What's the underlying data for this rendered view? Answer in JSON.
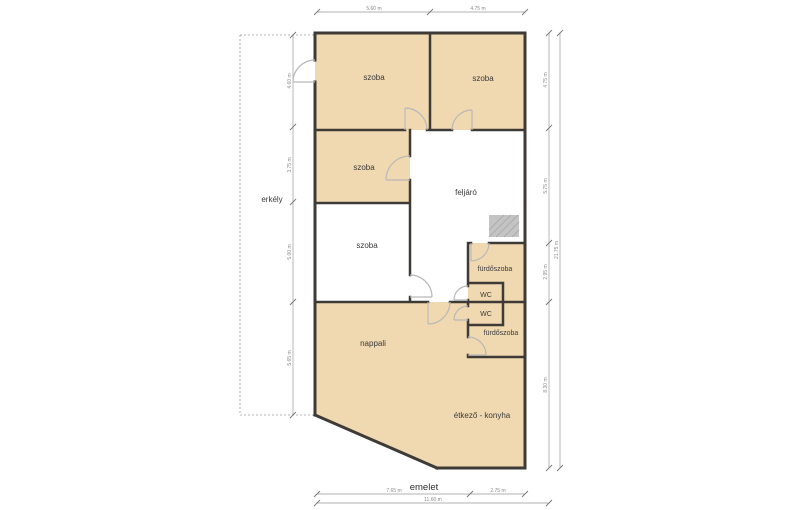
{
  "title": "emelet",
  "rooms": {
    "bedroom_top_left": "szoba",
    "bedroom_top_right": "szoba",
    "bedroom_middle": "szoba",
    "bedroom_lower": "szoba",
    "landing": "feljáró",
    "balcony": "erkély",
    "bathroom_upper": "fürdőszoba",
    "wc_upper": "WC",
    "wc_lower": "WC",
    "bathroom_lower": "fürdőszoba",
    "living_room": "nappali",
    "dining_kitchen": "étkező - konyha"
  },
  "dimensions": {
    "top": [
      "5.60 m",
      "4.75 m"
    ],
    "bottom": [
      "7.65 m",
      "2.75 m"
    ],
    "bottom_total": "11.60 m",
    "left": [
      "4.60 m",
      "3.75 m",
      "5.00 m",
      "5.65 m"
    ],
    "right": [
      "4.75 m",
      "5.75 m",
      "2.95 m",
      "8.30 m"
    ],
    "right_total": "21.75 m"
  },
  "colors": {
    "room_fill": "#f0d9b1",
    "wall": "#3e3a35",
    "door_arc": "#b9b9b9",
    "dimension_line": "#909090",
    "stairs_fill": "#c4c4c4"
  }
}
